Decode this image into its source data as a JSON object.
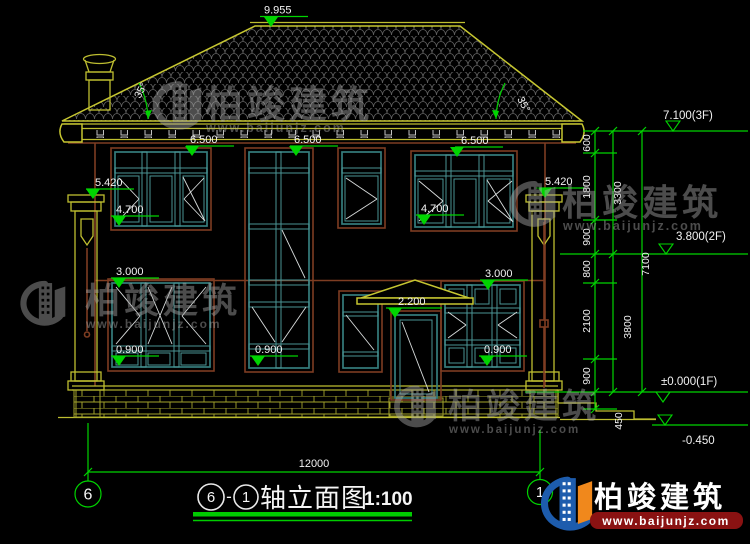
{
  "canvas": {
    "background": "#000000"
  },
  "colors": {
    "dimension_green": "#00d400",
    "structure_yellow": "#bebe30",
    "wall_brown": "#7e3d22",
    "window_teal": "#357d7d",
    "text_white": "#f2f2f2",
    "tile_grey": "#5f5f5f",
    "logo_blue": "#1d5cad",
    "logo_orange": "#f0881c",
    "banner_red": "#8a1212"
  },
  "annotations": {
    "ridge_level": "9.955",
    "roof_angle": "35°",
    "window_tags": [
      "6.500",
      "6.500",
      "6.500",
      "5.420",
      "5.420",
      "4.700",
      "4.700",
      "3.000",
      "3.000",
      "2.200",
      "0.900",
      "0.900",
      "0.900"
    ],
    "levels": [
      "7.100(3F)",
      "3.800(2F)",
      "±0.000(1F)",
      "-0.450"
    ],
    "chain_segments": [
      "600",
      "1800",
      "900",
      "800",
      "2100",
      "900",
      "450"
    ],
    "chain_totals": [
      "3300",
      "3800"
    ],
    "chain_overall": "7100",
    "overall_width": "12000"
  },
  "axes": {
    "left": "6",
    "right": "1"
  },
  "title": {
    "from": "6",
    "dash": "-",
    "to": "1",
    "name": "轴立面图",
    "scale": "1:100"
  },
  "watermark": {
    "brand": "柏竣建筑",
    "site": "www.baijunjz.com"
  },
  "logo": {
    "brand": "柏竣建筑",
    "site": "www.baijunjz.com"
  }
}
